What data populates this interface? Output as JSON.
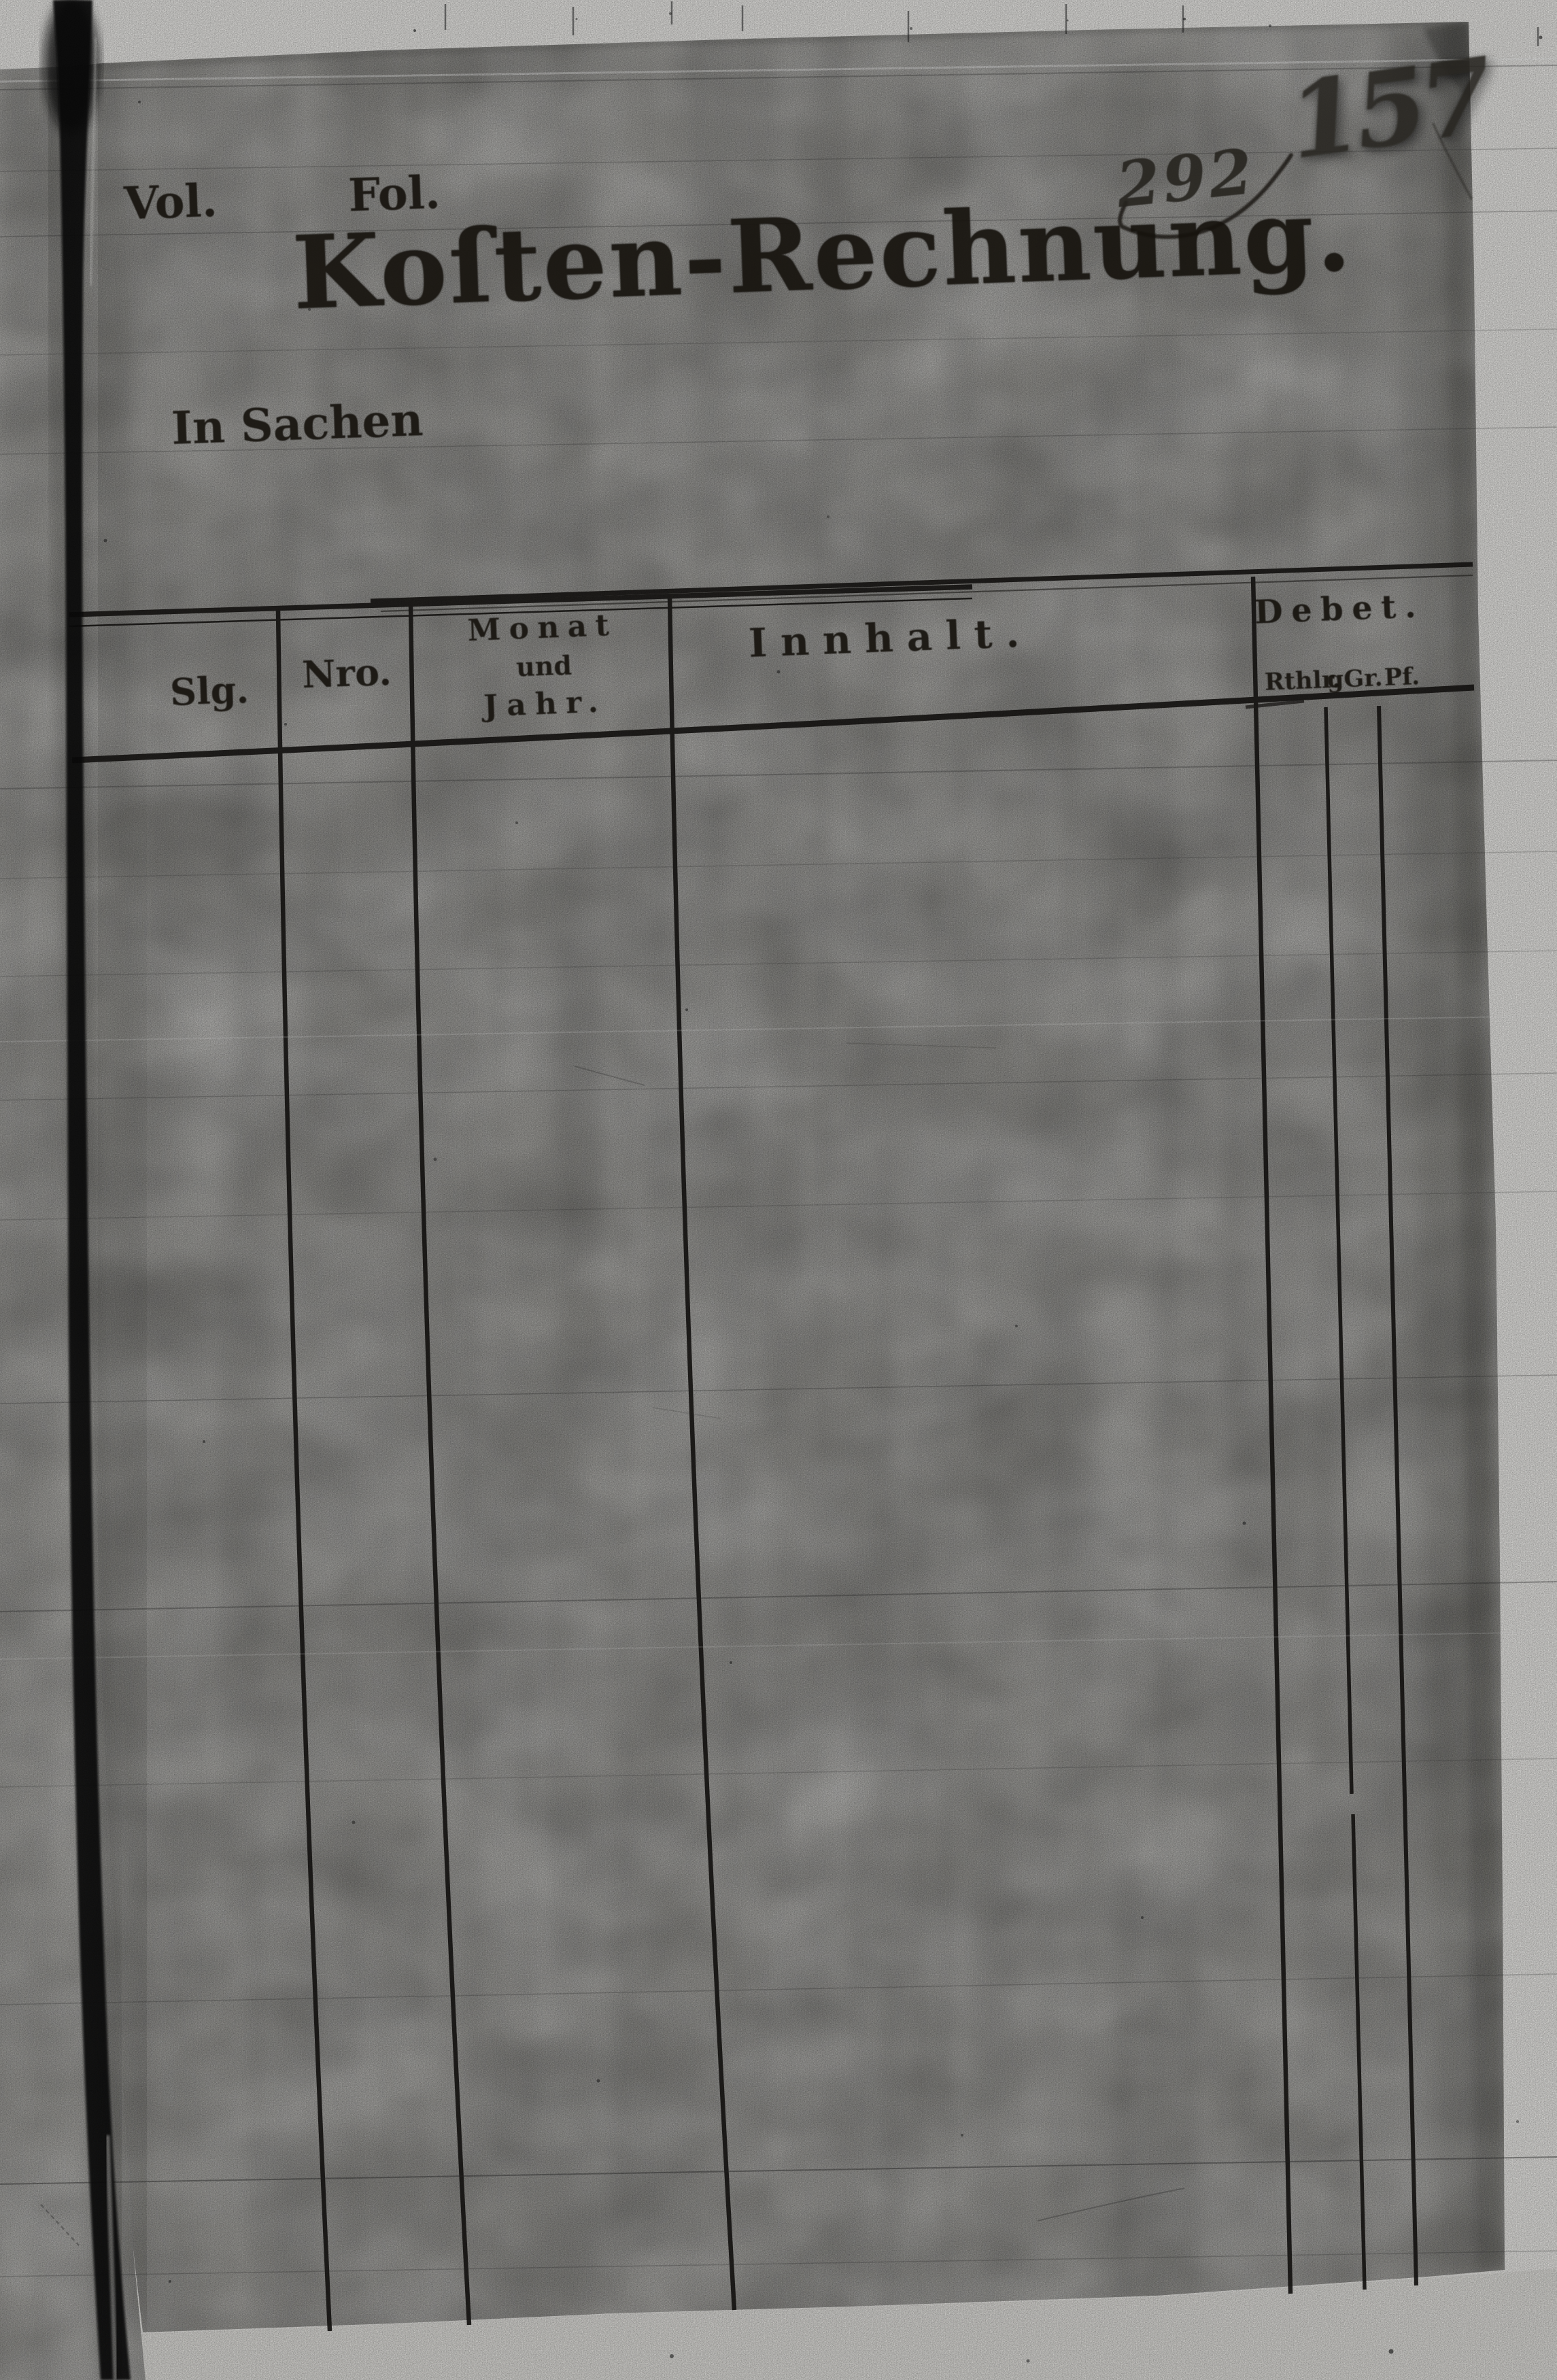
{
  "document": {
    "vol_label": "Vol.",
    "fol_label": "Fol.",
    "title": "Koſten-Rechnung.",
    "case_intro": "In Sachen",
    "archival_numbers": {
      "left": "292",
      "right": "157"
    },
    "table": {
      "col_slg": "Slg.",
      "col_nro": "Nro.",
      "col_monat": [
        "Monat",
        "und",
        "Jahr."
      ],
      "col_innhalt": "Innhalt.",
      "col_debet": "Debet.",
      "debet_sub": [
        "Rthlr.",
        "gGr.",
        "Pf."
      ]
    }
  },
  "colors": {
    "paper": "#a8a7a3",
    "margin": "#f1f0ed",
    "under_page": "#e7e6e2",
    "ink": "#16130e",
    "crease": "#0b0b0a"
  }
}
